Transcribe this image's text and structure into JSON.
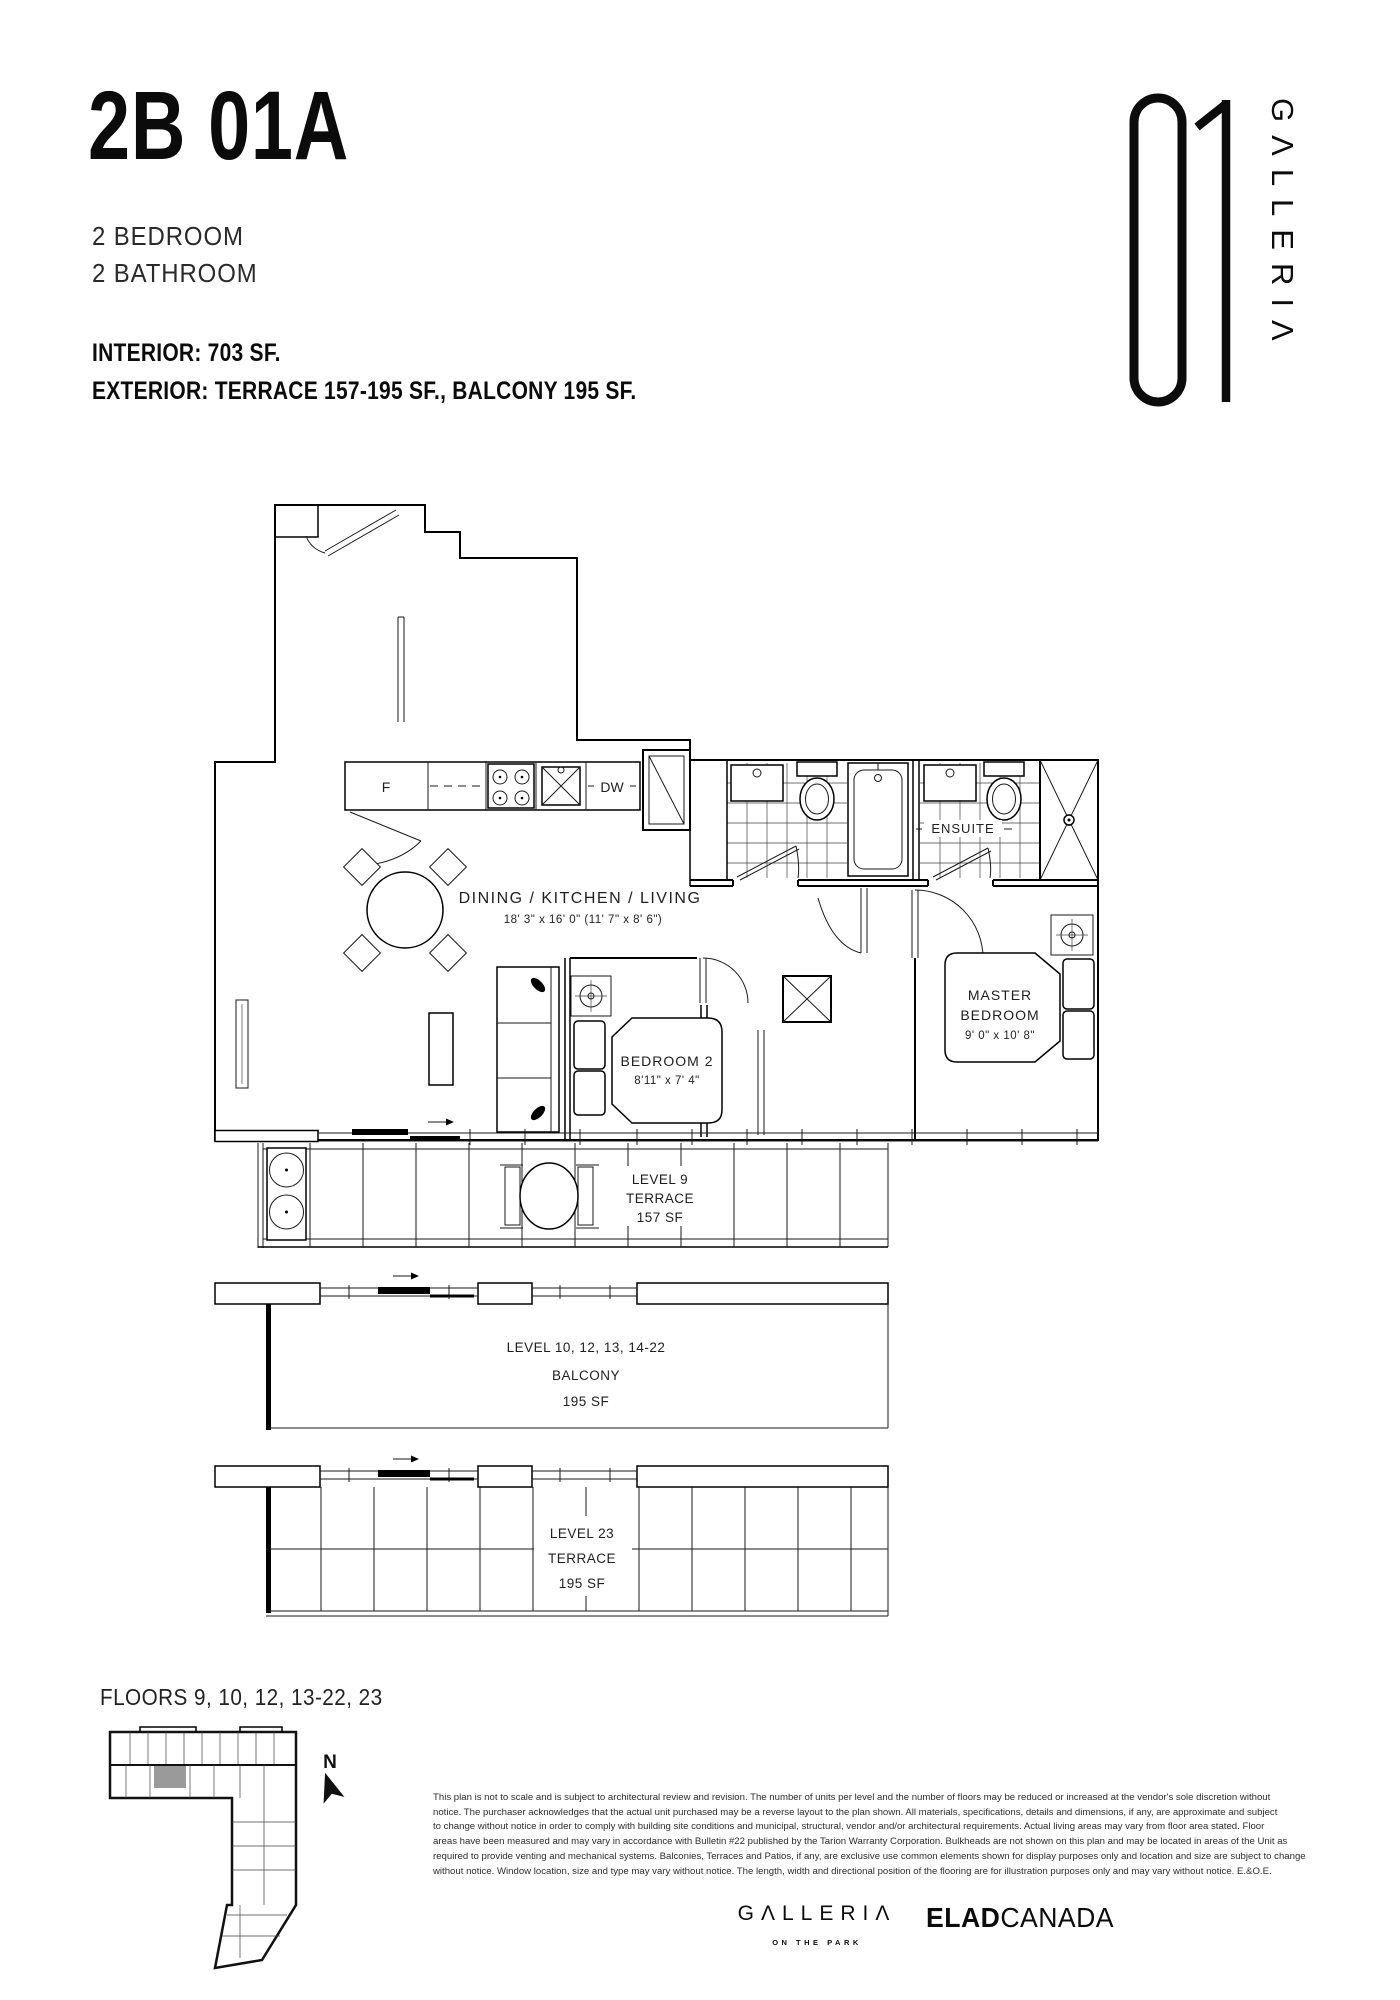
{
  "header": {
    "unit_code": "2B 01A",
    "spec_lines": [
      "2 BEDROOM",
      "2 BATHROOM"
    ],
    "interior_line": "INTERIOR: 703 SF.",
    "exterior_line": "EXTERIOR: TERRACE 157-195 SF., BALCONY 195 SF."
  },
  "logo": {
    "number": "01",
    "name": "GΛLLERIΛ"
  },
  "plan": {
    "rooms": {
      "living": {
        "name": "DINING / KITCHEN / LIVING",
        "dim": "18' 3\" x 16' 0\" (11' 7\" x 8' 6\")"
      },
      "master": {
        "line1": "MASTER",
        "line2": "BEDROOM",
        "dim": "9' 0\" x 10' 8\""
      },
      "bedroom2": {
        "name": "BEDROOM 2",
        "dim": "8'11\" x 7' 4\""
      },
      "ensuite": {
        "name": "ENSUITE"
      }
    },
    "appliances": {
      "fridge": "F",
      "dishwasher": "DW"
    },
    "outdoor": {
      "terrace9": {
        "line1": "LEVEL 9",
        "line2": "TERRACE",
        "line3": "157 SF"
      },
      "balcony": {
        "line1": "LEVEL 10, 12, 13, 14-22",
        "line2": "BALCONY",
        "line3": "195 SF"
      },
      "terrace23": {
        "line1": "LEVEL 23",
        "line2": "TERRACE",
        "line3": "195 SF"
      }
    }
  },
  "footer": {
    "floors_label": "FLOORS 9, 10, 12, 13-22, 23",
    "north": "N",
    "disclaimer_lines": [
      "This plan is not to scale and is subject to architectural review and revision. The number of units per level and the number of floors may be reduced or increased at the vendor's sole discretion without",
      "notice. The purchaser acknowledges that the actual unit purchased may be a reverse layout to the plan shown. All materials, specifications, details and dimensions, if any, are approximate and subject",
      "to change without notice in order to comply with building site conditions and municipal, structural, vendor and/or architectural requirements. Actual living areas may vary from floor area stated. Floor",
      "areas have been measured and may vary in accordance with Bulletin #22 published by the Tarion Warranty Corporation. Bulkheads are not shown on this plan and may be located in areas of the Unit as",
      "required to provide venting and mechanical systems. Balconies, Terraces and Patios, if any, are exclusive use common elements shown for display purposes only and location and size are subject to change",
      "without notice. Window location, size and type may vary without notice. The length, width and directional position of the flooring are for illustration purposes only and may vary without notice. E.&O.E."
    ],
    "brand": {
      "galleria": "GΛLLERIΛ",
      "galleria_sub": "ON THE PARK",
      "elad_bold": "ELAD",
      "elad_regular": "CANADA"
    }
  }
}
